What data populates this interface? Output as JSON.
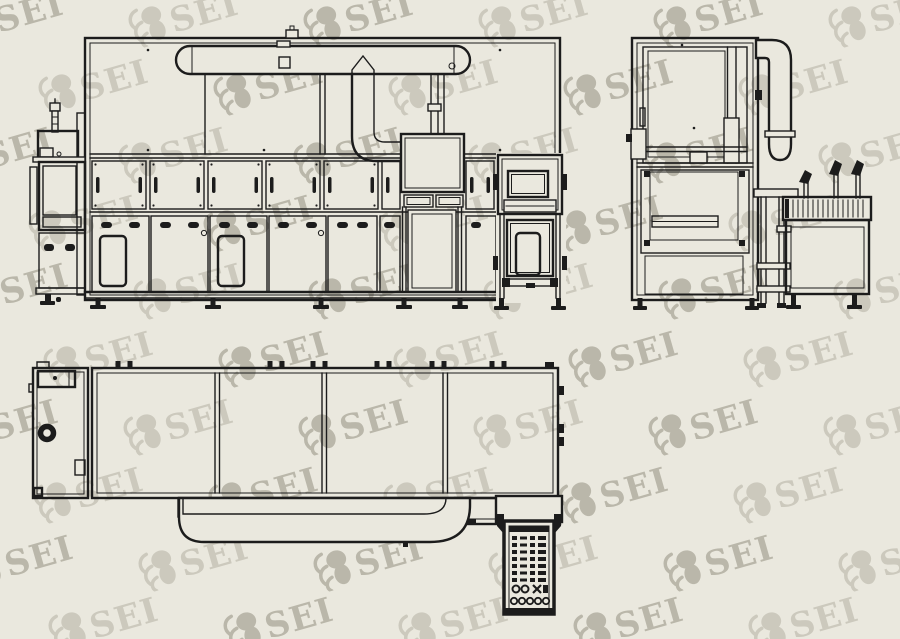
{
  "palette": {
    "background": "#eae8de",
    "line": "#1c1c1c",
    "watermark": "#a8a597"
  },
  "watermark": {
    "text": "SEI",
    "logo_icon": "sei-claw-logo",
    "rotation_deg": -16,
    "font_size_px": 34,
    "opacity_strong": 0.72,
    "opacity_light": 0.45,
    "grid": {
      "step_x": 175,
      "rows": [
        {
          "y": -8,
          "x0": -50
        },
        {
          "y": 60,
          "x0": 35
        },
        {
          "y": 128,
          "x0": -60
        },
        {
          "y": 196,
          "x0": 25
        },
        {
          "y": 264,
          "x0": -45
        },
        {
          "y": 332,
          "x0": 40
        },
        {
          "y": 400,
          "x0": -55
        },
        {
          "y": 468,
          "x0": 30
        },
        {
          "y": 536,
          "x0": -40
        },
        {
          "y": 598,
          "x0": 45
        }
      ]
    }
  },
  "drawing": {
    "views": [
      {
        "id": "front-elevation"
      },
      {
        "id": "side-elevation"
      },
      {
        "id": "plan"
      }
    ]
  }
}
